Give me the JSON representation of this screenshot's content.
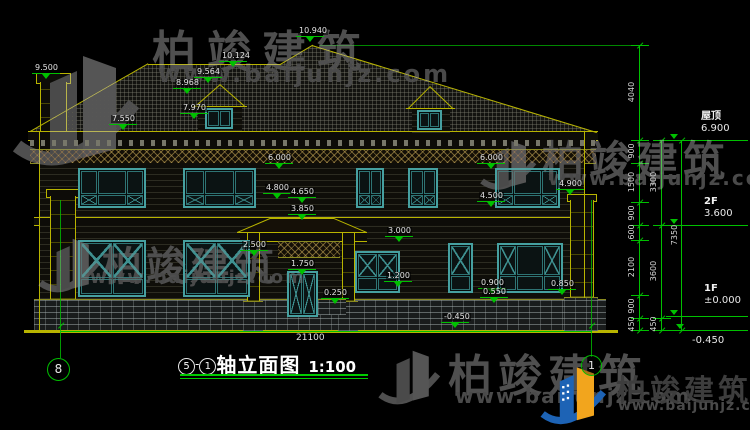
{
  "drawing_title": {
    "axis_start": "5",
    "axis_separator": "-",
    "axis_end": "1",
    "name": "轴立面图",
    "scale": "1:100"
  },
  "grid_bubbles": {
    "left": "8",
    "right": "1"
  },
  "watermark": {
    "brand": "柏竣建筑",
    "url": "www.baijunjz.com"
  },
  "total_width_dim": "21100",
  "levels": [
    {
      "label": "屋顶",
      "value": "6.900"
    },
    {
      "label": "2F",
      "value": "3.600"
    },
    {
      "label": "1F",
      "value": "±0.000"
    },
    {
      "label": "",
      "value": "-0.450"
    }
  ],
  "vertical_dims": [
    {
      "t": "4040",
      "cx": 632,
      "cy": 92
    },
    {
      "t": "900",
      "cx": 632,
      "cy": 151
    },
    {
      "t": "1500",
      "cx": 632,
      "cy": 182
    },
    {
      "t": "900",
      "cx": 632,
      "cy": 213
    },
    {
      "t": "600",
      "cx": 632,
      "cy": 232
    },
    {
      "t": "2100",
      "cx": 632,
      "cy": 267
    },
    {
      "t": "900",
      "cx": 632,
      "cy": 306
    },
    {
      "t": "450",
      "cx": 632,
      "cy": 324
    },
    {
      "t": "3300",
      "cx": 654,
      "cy": 182
    },
    {
      "t": "3600",
      "cx": 654,
      "cy": 271
    },
    {
      "t": "450",
      "cx": 654,
      "cy": 324
    },
    {
      "t": "7350",
      "cx": 675,
      "cy": 235
    }
  ],
  "elevation_marks": [
    {
      "t": "9.500",
      "x": 34,
      "y": 64
    },
    {
      "t": "10.124",
      "x": 221,
      "y": 52
    },
    {
      "t": "10.940",
      "x": 298,
      "y": 27
    },
    {
      "t": "9.564",
      "x": 196,
      "y": 68
    },
    {
      "t": "8.968",
      "x": 175,
      "y": 79
    },
    {
      "t": "7.970",
      "x": 182,
      "y": 104
    },
    {
      "t": "7.550",
      "x": 111,
      "y": 115
    },
    {
      "t": "6.000",
      "x": 267,
      "y": 154
    },
    {
      "t": "4.800",
      "x": 265,
      "y": 184
    },
    {
      "t": "4.650",
      "x": 290,
      "y": 188
    },
    {
      "t": "3.850",
      "x": 290,
      "y": 205
    },
    {
      "t": "6.000",
      "x": 479,
      "y": 154
    },
    {
      "t": "4.500",
      "x": 479,
      "y": 192
    },
    {
      "t": "4.900",
      "x": 558,
      "y": 180
    },
    {
      "t": "2.500",
      "x": 242,
      "y": 241
    },
    {
      "t": "3.000",
      "x": 387,
      "y": 227
    },
    {
      "t": "1.750",
      "x": 290,
      "y": 260
    },
    {
      "t": "1.200",
      "x": 386,
      "y": 272
    },
    {
      "t": "0.250",
      "x": 323,
      "y": 289
    },
    {
      "t": "0.900",
      "x": 480,
      "y": 279
    },
    {
      "t": "0.550",
      "x": 482,
      "y": 288
    },
    {
      "t": "0.850",
      "x": 550,
      "y": 280
    },
    {
      "t": "-0.450",
      "x": 443,
      "y": 313
    }
  ]
}
